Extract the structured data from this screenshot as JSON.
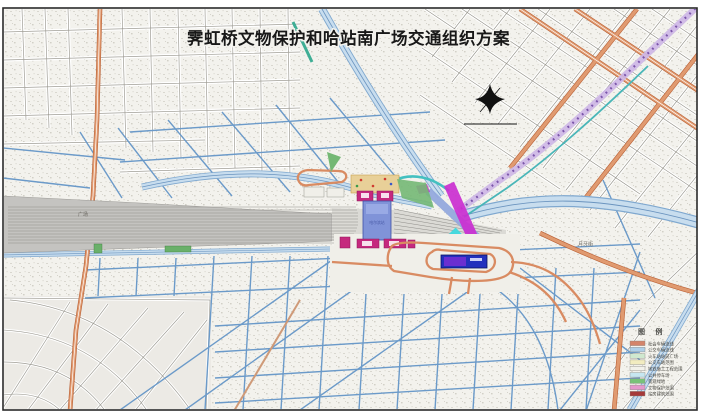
{
  "title": "霁虹桥文物保护和哈站南广场交通组织方案",
  "map_labels": {
    "station_hall": "哈尔滨站",
    "rail_yard": "广场",
    "street_right": "月牙街"
  },
  "north_arrow_icon": "compass-north-arrow",
  "legend": {
    "title": "图 例",
    "items": [
      {
        "label": "社会车辆流线",
        "color": "#d4846a"
      },
      {
        "label": "公交车辆流线",
        "color": "#aecfe8"
      },
      {
        "label": "火车站站前广场",
        "color": "#cfe8cf"
      },
      {
        "label": "公交车站范围",
        "color": "#f2ecc0"
      },
      {
        "label": "地铁施工工程范围",
        "color": "#f2f1ea"
      },
      {
        "label": "公共停车场",
        "color": "#c6e6f0"
      },
      {
        "label": "景观绿地",
        "color": "#79c279"
      },
      {
        "label": "文物保护范围",
        "color": "#e598cc"
      },
      {
        "label": "站房建筑范围",
        "color": "#a63a3a"
      }
    ]
  },
  "colors": {
    "road_orange": "#d98b62",
    "road_blue": "#6b9ac9",
    "metro_purple": "#cdb6e6",
    "bridge_magenta": "#cb2fd0",
    "bridge_cyan": "#3fd9de",
    "rail_gray": "#c4c3c0",
    "station_blue": "#8093d8",
    "station_magenta": "#c5297e",
    "plaza_yellow": "#e8d098"
  }
}
